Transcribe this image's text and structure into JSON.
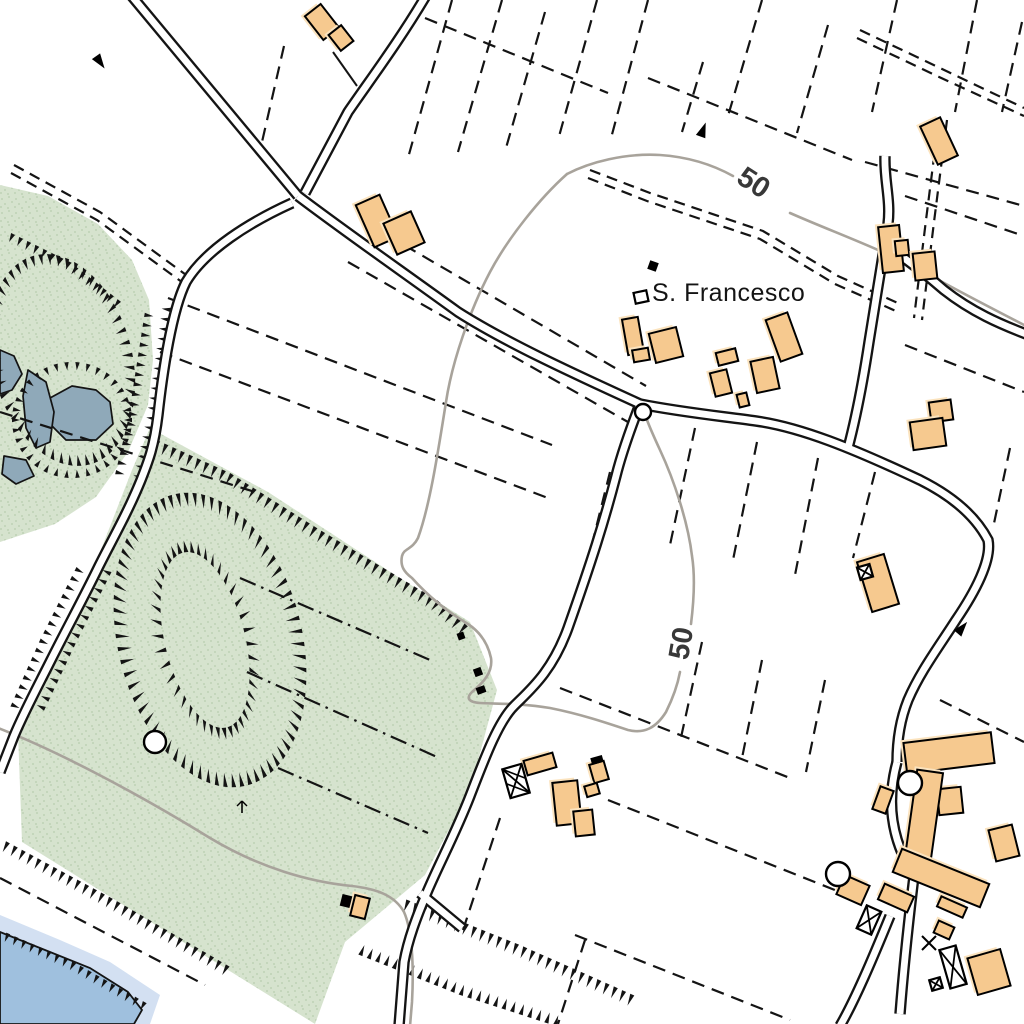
{
  "map": {
    "kind": "topographic-map",
    "labels": {
      "place": "S. Francesco",
      "contour_top": "50",
      "contour_mid": "50"
    },
    "colors": {
      "background": "#ffffff",
      "ink": "#141414",
      "vegetation": "#d6e3ce",
      "vegetation_speckle": "#aec7a5",
      "water_pond": "#8fa9b9",
      "water_lake": "#9fc0de",
      "water_fringe": "#d3e0f2",
      "contour": "#a8a39b",
      "building_fill": "#f6c98f",
      "building_halo": "#fbe3be"
    },
    "vegetation_polygons": [
      "0,185 48,196 98,224 132,260 149,300 153,360 148,405 128,452 96,497 55,524 0,542",
      "150,428 268,492 395,575 470,622 497,690 470,790 425,875 345,942 315,1024 22,842 18,732 50,660 95,565 132,470"
    ],
    "water": {
      "fringe": "0,915 60,940 110,962 160,995 150,1024 0,1024",
      "lake": "0,932 45,950 90,968 128,992 142,1010 134,1024 0,1024",
      "ponds": [
        "50,398 72,386 96,390 110,402 113,424 96,440 66,440 50,424",
        "28,370 46,382 54,412 50,442 36,448 26,428 23,396",
        "0,350 14,356 22,374 12,390 0,394",
        "4,456 26,460 34,476 16,484 2,474"
      ]
    },
    "contours": [
      "M 790,213 C 840,235 880,248 935,278 C 975,300 1005,315 1026,326",
      "M 567,174 C 590,162 625,153 660,155 C 690,157 715,166 733,176",
      "M 567,174 C 540,198 508,238 490,272 C 470,310 452,362 446,402 C 438,452 430,505 418,538 C 412,550 404,548 402,556 C 400,566 404,572 412,578 C 428,596 448,612 468,624 C 480,632 488,644 491,658 C 493,672 484,682 472,692 C 466,698 468,702 480,703 C 496,704 520,703 550,708 C 580,714 604,722 628,730 C 644,734 656,728 666,712 C 672,700 677,688 680,672",
      "M 691,624 C 694,600 695,575 692,556 C 688,522 674,480 660,450 C 654,437 650,428 647,420",
      "M -2,728 C 60,752 140,795 210,838 C 260,868 310,882 352,886 C 378,889 395,896 404,912 C 412,930 414,965 412,1002 L 410,1026"
    ],
    "parcel_dashed": [
      [
        425,
        18,
        608,
        93
      ],
      [
        284,
        46,
        262,
        142
      ],
      [
        452,
        0,
        408,
        158
      ],
      [
        502,
        0,
        458,
        152
      ],
      [
        545,
        12,
        506,
        148
      ],
      [
        597,
        0,
        558,
        140
      ],
      [
        648,
        0,
        610,
        142
      ],
      [
        703,
        62,
        682,
        132
      ],
      [
        762,
        0,
        728,
        116
      ],
      [
        828,
        25,
        797,
        133
      ],
      [
        897,
        0,
        872,
        112
      ],
      [
        977,
        0,
        955,
        112
      ],
      [
        1022,
        22,
        1002,
        112
      ],
      [
        648,
        78,
        852,
        160
      ],
      [
        865,
        162,
        1024,
        206
      ],
      [
        905,
        196,
        1024,
        236
      ],
      [
        168,
        298,
        552,
        445
      ],
      [
        160,
        352,
        548,
        498
      ],
      [
        0,
        412,
        255,
        492
      ],
      [
        368,
        224,
        646,
        386
      ],
      [
        348,
        262,
        628,
        422
      ],
      [
        695,
        428,
        670,
        545
      ],
      [
        757,
        442,
        733,
        560
      ],
      [
        818,
        458,
        795,
        575
      ],
      [
        875,
        472,
        853,
        558
      ],
      [
        905,
        345,
        1024,
        392
      ],
      [
        1010,
        448,
        993,
        528
      ],
      [
        610,
        472,
        588,
        560
      ],
      [
        560,
        688,
        790,
        778
      ],
      [
        608,
        800,
        855,
        898
      ],
      [
        702,
        642,
        680,
        742
      ],
      [
        762,
        660,
        742,
        758
      ],
      [
        825,
        680,
        806,
        772
      ],
      [
        500,
        818,
        463,
        930
      ],
      [
        585,
        940,
        558,
        1024
      ],
      [
        575,
        935,
        790,
        1020
      ],
      [
        0,
        878,
        205,
        985
      ],
      [
        940,
        700,
        1024,
        742
      ]
    ],
    "parcel_dashdot": [
      [
        240,
        578,
        430,
        660
      ],
      [
        247,
        672,
        437,
        757
      ],
      [
        278,
        768,
        428,
        833
      ]
    ],
    "tracks": [
      "590,170 650,193 763,231 838,276 900,304",
      "588,178 647,201 760,239 835,284 898,312",
      "860,30 940,68 1024,108",
      "857,38 937,76 1024,116",
      "939,118 926,220 914,318",
      "947,120 934,222 922,320",
      "14,165 100,212 193,280",
      "11,173 97,220 190,288"
    ],
    "roads": [
      "M 130,-6 L 298,196",
      "M 427,-6 C 400,40 370,80 348,112 L 305,193",
      "M 298,196 C 340,228 400,270 458,312 C 505,342 570,372 640,404",
      "M 292,203 C 250,222 205,250 186,282 C 172,310 163,370 158,415 C 154,448 148,462 141,480 C 128,512 112,540 99,566 C 84,597 65,632 51,660 C 38,686 24,712 14,736 L 0,772",
      "M 640,404 C 630,430 622,452 616,476 C 604,522 592,560 568,628 C 552,672 530,690 514,706 C 498,722 484,760 470,796 C 456,832 440,862 428,890 C 416,918 408,940 404,962 L 399,1026",
      "M 420,893 L 462,928",
      "M 640,404 C 680,412 720,416 756,421 C 800,427 852,448 920,480 C 952,496 975,515 988,540 C 992,560 975,592 956,620 C 938,648 920,672 908,700 C 900,720 897,740 897,762",
      "M 848,448 C 858,410 864,375 869,342 C 876,300 882,262 888,224 C 891,200 884,180 885,156",
      "M 890,248 C 910,262 928,276 944,290 C 972,312 1000,324 1026,334",
      "M 897,762 C 888,795 888,835 914,876 C 910,910 905,950 900,1014",
      "M 840,1026 C 855,1000 872,960 890,916"
    ],
    "solid_lines": [
      [
        333,
        52,
        357,
        86
      ]
    ],
    "buildings": [
      [
        322,
        22,
        20,
        30,
        -38
      ],
      [
        341,
        38,
        16,
        20,
        -38
      ],
      [
        377,
        221,
        26,
        46,
        -24
      ],
      [
        404,
        233,
        30,
        34,
        -24
      ],
      [
        633,
        336,
        16,
        36,
        -10
      ],
      [
        641,
        355,
        16,
        12,
        -10
      ],
      [
        666,
        345,
        28,
        30,
        -14
      ],
      [
        727,
        357,
        20,
        13,
        -14
      ],
      [
        721,
        383,
        17,
        24,
        -14
      ],
      [
        765,
        375,
        23,
        32,
        -12
      ],
      [
        784,
        337,
        23,
        44,
        -20
      ],
      [
        743,
        400,
        10,
        13,
        -14
      ],
      [
        891,
        249,
        21,
        46,
        -6
      ],
      [
        902,
        248,
        13,
        15,
        -6
      ],
      [
        925,
        266,
        22,
        27,
        -6
      ],
      [
        939,
        141,
        22,
        42,
        -25
      ],
      [
        941,
        411,
        22,
        20,
        -8
      ],
      [
        928,
        434,
        33,
        28,
        -8
      ],
      [
        878,
        583,
        28,
        52,
        -17
      ],
      [
        540,
        764,
        30,
        15,
        -16
      ],
      [
        599,
        772,
        15,
        19,
        -16
      ],
      [
        592,
        790,
        13,
        11,
        -16
      ],
      [
        567,
        803,
        25,
        43,
        -6
      ],
      [
        584,
        823,
        19,
        25,
        -6
      ],
      [
        883,
        800,
        14,
        24,
        20
      ],
      [
        950,
        801,
        24,
        26,
        -6
      ],
      [
        1004,
        843,
        24,
        32,
        -14
      ],
      [
        853,
        890,
        27,
        21,
        24
      ],
      [
        896,
        898,
        32,
        17,
        24
      ],
      [
        944,
        930,
        17,
        13,
        24
      ],
      [
        989,
        972,
        34,
        38,
        -16
      ],
      [
        952,
        907,
        28,
        11,
        24
      ],
      [
        360,
        907,
        15,
        21,
        14
      ],
      [
        949,
        753,
        88,
        31,
        -7
      ],
      [
        924,
        815,
        26,
        88,
        8
      ],
      [
        941,
        878,
        94,
        25,
        22
      ]
    ],
    "black_structures": [
      {
        "cx": 516,
        "cy": 781,
        "w": 20,
        "h": 30,
        "rot": -16,
        "type": "hatched"
      },
      {
        "cx": 869,
        "cy": 920,
        "w": 16,
        "h": 25,
        "rot": 24,
        "type": "crossed"
      },
      {
        "cx": 953,
        "cy": 967,
        "w": 17,
        "h": 40,
        "rot": -16,
        "type": "crossed"
      },
      {
        "cx": 865,
        "cy": 572,
        "w": 13,
        "h": 13,
        "rot": -16,
        "type": "crossed"
      },
      {
        "cx": 936,
        "cy": 984,
        "w": 11,
        "h": 11,
        "rot": -16,
        "type": "crossed"
      },
      {
        "cx": 641,
        "cy": 297,
        "w": 13,
        "h": 11,
        "rot": -12,
        "type": "outline"
      }
    ],
    "black_squares": [
      [
        653,
        266,
        9,
        9,
        20
      ],
      [
        346,
        901,
        10,
        12,
        14
      ],
      [
        478,
        672,
        8,
        8,
        -20
      ],
      [
        481,
        690,
        9,
        7,
        -20
      ],
      [
        597,
        760,
        12,
        7,
        -16
      ],
      [
        461,
        636,
        7,
        7,
        -20
      ]
    ],
    "circles": [
      [
        643,
        412,
        8
      ],
      [
        910,
        783,
        12
      ],
      [
        838,
        874,
        12
      ],
      [
        155,
        742,
        11
      ]
    ],
    "x_marks": [
      [
        929,
        943,
        7
      ]
    ],
    "arrows": [
      [
        100,
        62,
        145
      ],
      [
        703,
        130,
        20
      ],
      [
        962,
        628,
        40
      ]
    ],
    "trees": [
      [
        242,
        807
      ]
    ],
    "hachure_rings": [
      {
        "cx": 210,
        "cy": 640,
        "rx": 92,
        "ry": 150,
        "rot": -14,
        "dir": "in",
        "len": 14,
        "gap": 11
      },
      {
        "cx": 205,
        "cy": 640,
        "rx": 40,
        "ry": 90,
        "rot": -14,
        "dir": "out",
        "len": 12,
        "gap": 10
      },
      {
        "cx": 62,
        "cy": 360,
        "rx": 70,
        "ry": 108,
        "rot": -15,
        "dir": "in",
        "len": 11,
        "gap": 11
      },
      {
        "cx": 72,
        "cy": 420,
        "rx": 60,
        "ry": 58,
        "rot": 0,
        "dir": "in",
        "len": 8,
        "gap": 11
      }
    ],
    "hachure_rows": [
      {
        "pts": "150,437 230,473 320,530 437,600 472,630",
        "side": 1,
        "len": 12,
        "gap": 9
      },
      {
        "pts": "0,838 115,900 232,968",
        "side": 1,
        "len": 11,
        "gap": 9
      },
      {
        "pts": "0,930 70,960 148,1004",
        "side": 1,
        "len": 9,
        "gap": 9
      },
      {
        "pts": "400,897 520,945 640,998",
        "side": 1,
        "len": 12,
        "gap": 9
      },
      {
        "pts": "352,952 460,995 562,1028",
        "side": -1,
        "len": 11,
        "gap": 9
      },
      {
        "pts": "146,305 128,420 115,475",
        "side": -1,
        "len": 9,
        "gap": 10
      },
      {
        "pts": "172,300 155,420 142,478",
        "side": 1,
        "len": 9,
        "gap": 10
      },
      {
        "pts": "5,230 70,262 125,305",
        "side": 1,
        "len": 9,
        "gap": 9
      },
      {
        "pts": "80,560 40,640 8,712",
        "side": -1,
        "len": 9,
        "gap": 10
      },
      {
        "pts": "115,565 75,645 42,715",
        "side": 1,
        "len": 9,
        "gap": 10
      }
    ]
  }
}
